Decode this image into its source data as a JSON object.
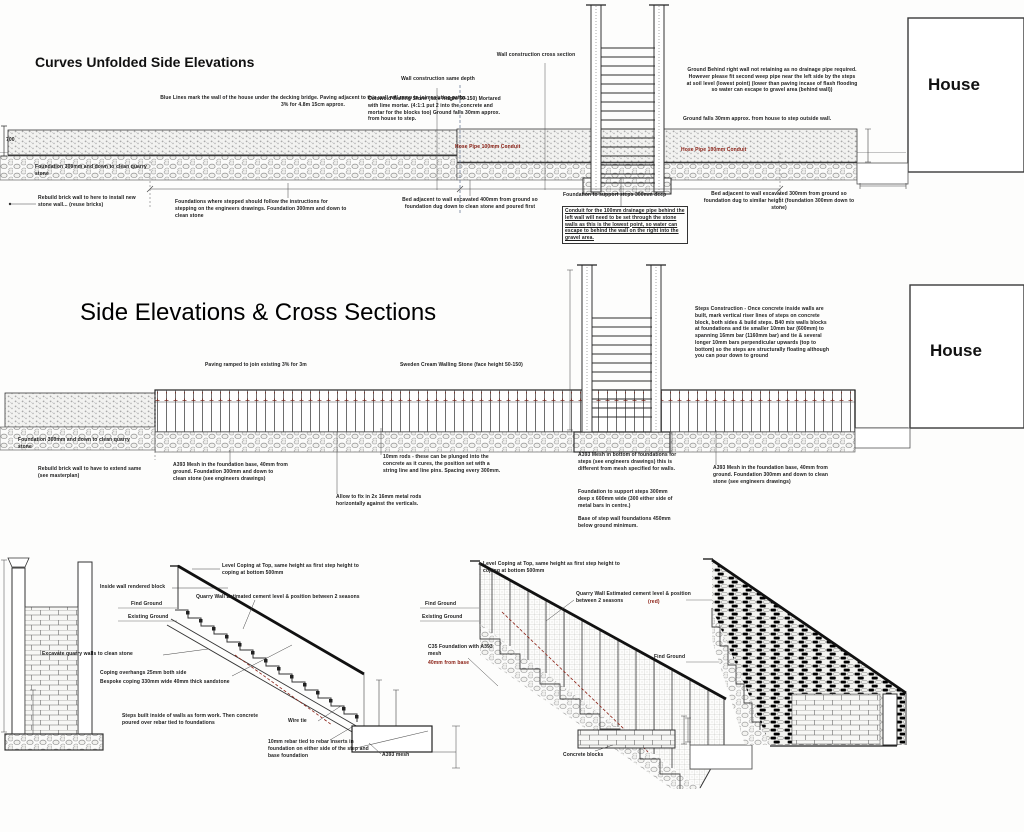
{
  "titles": {
    "top": "Curves Unfolded Side Elevations",
    "middle": "Side Elevations & Cross Sections",
    "house_top": "House",
    "house_middle": "House"
  },
  "colors": {
    "ink": "#1c1c1c",
    "red_accent": "#8b2015",
    "ground_gray": "#c4c4c4"
  },
  "top": {
    "ann": [
      "Blue Lines mark the wall of the house under the decking bridge. Paving adjacent to this wall will ramp to join existing paths 3% for 4.8m 15cm approx.",
      "Wall construction same depth",
      "Wall construction cross section",
      "Cotswold Walling Stone (face height 50-150) Mortared with lime mortar. (4:1:1 put 2 into the concrete and mortar for the blocks too) Ground falls 30mm approx. from house to step.",
      "Ground Behind right wall not retaining as no drainage pipe required. However please fit second weep pipe near the left side by the steps at soil level (lowest point) (lower than paving incase of flash flooding so water can escape to gravel area (behind wall))",
      "Ground falls 30mm approx. from house to step outside wall.",
      "Hose Pipe 100mm Conduit",
      "Hose Pipe 100mm Conduit",
      "Foundation 300mm and down to clean quarry stone",
      "Rebuild brick wall to here to install new stone wall... (reuse bricks)",
      "Foundations where stepped should follow the instructions for stepping on the engineers drawings. Foundation 300mm and down to clean stone",
      "Bed adjacent to wall excavated 400mm from ground so foundation dug down to clean stone and poured first",
      "Foundation to support steps 300mm deep",
      "Conduit for the 100mm drainage pipe behind the left wall will need to be set through the stone walls as this is the lowest point, so water can escape to behind the wall on the right into the gravel area.",
      "Bed adjacent to wall excavated 300mm from ground so foundation dug to similar height (foundation 300mm down to stone)",
      "700"
    ]
  },
  "mid": {
    "ann": [
      "Paving ramped to join existing 3% for 3m",
      "Sweden Cream Walling Stone (face height 50-150)",
      "Steps Construction - Once concrete inside walls are built, mark vertical riser lines of steps on concrete block, both sides & build steps. B40 mix walls blocks at foundations and tie smaller 10mm bar (600mm) to spanning 16mm bar (1160mm bar) and tie & several longer 10mm bars perpendicular upwards (top to bottom) so the steps are structurally floating although you can pour down to ground",
      "Foundation 300mm and down to clean quarry stone",
      "Rebuild brick wall to have to extend same (see masterplan)",
      "A393 Mesh in the foundation base, 40mm from ground. Foundation 300mm and down to clean stone (see engineers drawings)",
      "10mm rods - these can be plunged into the concrete as it cures, the position set with a string line and line pins. Spacing every 300mm.",
      "Allow to fix in 2x 16mm metal rods horizontally against the verticals.",
      "A393 Mesh in bottom of foundations for steps (see engineers drawings) this is different from mesh specified for walls.",
      "Foundation to support steps 300mm deep x 600mm wide (300 either side of metal bars in centre.)",
      "Base of step wall foundations 450mm below ground minimum.",
      "A393 Mesh in the foundation base, 40mm from ground. Foundation 300mm and down to clean stone (see engineers drawings)"
    ]
  },
  "bot": {
    "ann": [
      "Level Coping at Top, same height as first step height to coping at bottom 500mm",
      "Inside wall rendered block",
      "Quarry Wall Estimated cement level & position between 2 seasons",
      "Find Ground",
      "Existing Ground",
      "Excavate quarry walls to clean stone",
      "Coping overhangs 25mm both side",
      "Bespoke coping 330mm wide 40mm thick sandstone",
      "Steps built inside of walls as form work. Then concrete poured over rebar tied to foundations",
      "Wire tie",
      "10mm rebar tied to rebar inserts in foundation on either side of the step and base foundation",
      "A393 mesh",
      "Level Coping at Top, same height as first step height to coping at bottom 500mm",
      "Quarry Wall Estimated cement level & position between 2 seasons",
      "(red)",
      "Find Ground",
      "Existing Ground",
      "C35 Foundation with A393 mesh",
      "40mm from base",
      "Find Ground",
      "Concrete blocks"
    ]
  }
}
